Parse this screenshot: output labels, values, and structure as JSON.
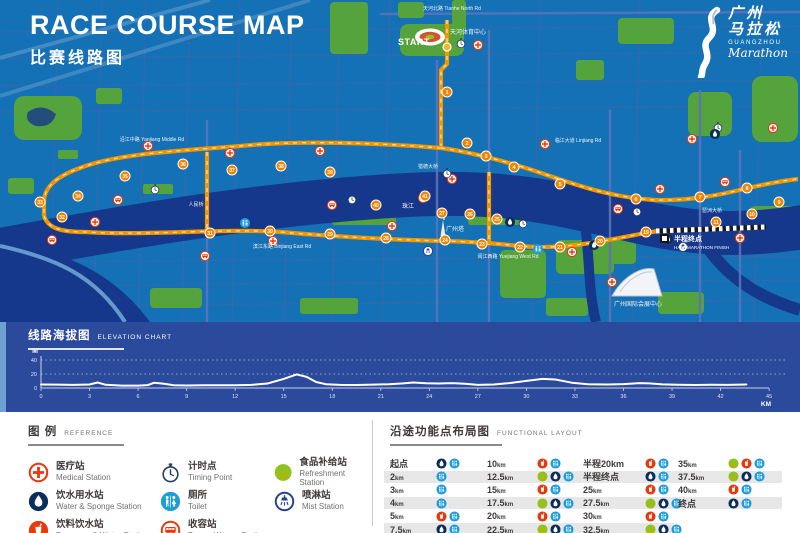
{
  "page": {
    "title_en": "RACE COURSE MAP",
    "title_zh": "比赛线路图"
  },
  "logo": {
    "zh1": "广州",
    "zh2": "马拉松",
    "en1": "GUANGZHOU",
    "en2": "Marathon"
  },
  "colors": {
    "map_bg": "#1471b5",
    "river": "#16388c",
    "shore": "#79b1dd",
    "park": "#55a33c",
    "road": "#4a63ac",
    "road_major": "#5b74bb",
    "road_light": "#6fa4d4",
    "route": "#f29600",
    "route_dash": "#ffdfa8",
    "marker": "#f08300",
    "panel": "#2b4a9b",
    "red": "#e8380d",
    "green": "#8fc31f",
    "orange": "#f39800",
    "navy": "#0b2d5b",
    "blue": "#1e9cd7",
    "ring_navy": "#24418f",
    "gray_bar": "#e7e7e8",
    "text_dark": "#3e3a39",
    "text_gray": "#727171"
  },
  "map": {
    "start_label": "START",
    "half_finish": {
      "zh": "半程终点",
      "en": "HALF MARATHON FINISH"
    },
    "labels": [
      {
        "t": "天河北路 Tianhe North Rd",
        "x": 452,
        "y": 10,
        "s": 5
      },
      {
        "t": "天河体育中心",
        "x": 468,
        "y": 34,
        "s": 6
      },
      {
        "t": "临江大道 Linjiang Rd",
        "x": 578,
        "y": 142,
        "s": 5
      },
      {
        "t": "沿江中路 Yanjiang Middle Rd",
        "x": 152,
        "y": 141,
        "s": 5
      },
      {
        "t": "滨江东路 Binjiang East Rd",
        "x": 282,
        "y": 248,
        "s": 5
      },
      {
        "t": "阅江西路 Yuejiang West Rd",
        "x": 508,
        "y": 258,
        "s": 5
      },
      {
        "t": "珠江",
        "x": 408,
        "y": 208,
        "s": 6
      },
      {
        "t": "广州塔",
        "x": 455,
        "y": 231,
        "s": 6
      },
      {
        "t": "猎德大桥",
        "x": 428,
        "y": 168,
        "s": 5
      },
      {
        "t": "人民桥",
        "x": 196,
        "y": 206,
        "s": 5
      },
      {
        "t": "琶洲大桥",
        "x": 712,
        "y": 212,
        "s": 5
      },
      {
        "t": "广州国际会展中心",
        "x": 638,
        "y": 306,
        "s": 6
      }
    ],
    "km_markers": [
      {
        "n": 1,
        "x": 447,
        "y": 92
      },
      {
        "n": 2,
        "x": 467,
        "y": 143
      },
      {
        "n": 3,
        "x": 486,
        "y": 156
      },
      {
        "n": 4,
        "x": 514,
        "y": 167
      },
      {
        "n": 5,
        "x": 560,
        "y": 184
      },
      {
        "n": 6,
        "x": 636,
        "y": 199
      },
      {
        "n": 7,
        "x": 700,
        "y": 197
      },
      {
        "n": 8,
        "x": 747,
        "y": 188
      },
      {
        "n": 9,
        "x": 779,
        "y": 202
      },
      {
        "n": 10,
        "x": 752,
        "y": 214
      },
      {
        "n": 11,
        "x": 716,
        "y": 222
      },
      {
        "n": 19,
        "x": 646,
        "y": 232
      },
      {
        "n": 20,
        "x": 600,
        "y": 241
      },
      {
        "n": 21,
        "x": 560,
        "y": 247
      },
      {
        "n": 22,
        "x": 520,
        "y": 247
      },
      {
        "n": 23,
        "x": 482,
        "y": 244
      },
      {
        "n": 24,
        "x": 445,
        "y": 240
      },
      {
        "n": 25,
        "x": 497,
        "y": 219
      },
      {
        "n": 26,
        "x": 470,
        "y": 214
      },
      {
        "n": 27,
        "x": 442,
        "y": 213
      },
      {
        "n": 28,
        "x": 386,
        "y": 238
      },
      {
        "n": 29,
        "x": 330,
        "y": 234
      },
      {
        "n": 30,
        "x": 270,
        "y": 231
      },
      {
        "n": 31,
        "x": 210,
        "y": 233
      },
      {
        "n": 32,
        "x": 62,
        "y": 217
      },
      {
        "n": 33,
        "x": 40,
        "y": 202
      },
      {
        "n": 34,
        "x": 78,
        "y": 196
      },
      {
        "n": 35,
        "x": 125,
        "y": 176
      },
      {
        "n": 36,
        "x": 183,
        "y": 164
      },
      {
        "n": 37,
        "x": 232,
        "y": 170
      },
      {
        "n": 38,
        "x": 281,
        "y": 166
      },
      {
        "n": 39,
        "x": 330,
        "y": 172
      },
      {
        "n": 40,
        "x": 376,
        "y": 205
      },
      {
        "n": 41,
        "x": 425,
        "y": 196
      }
    ],
    "stations": [
      {
        "t": "medical",
        "x": 478,
        "y": 45
      },
      {
        "t": "medical",
        "x": 148,
        "y": 146
      },
      {
        "t": "medical",
        "x": 230,
        "y": 153
      },
      {
        "t": "medical",
        "x": 320,
        "y": 151
      },
      {
        "t": "medical",
        "x": 95,
        "y": 222
      },
      {
        "t": "medical",
        "x": 273,
        "y": 241
      },
      {
        "t": "medical",
        "x": 392,
        "y": 226
      },
      {
        "t": "medical",
        "x": 452,
        "y": 179
      },
      {
        "t": "medical",
        "x": 545,
        "y": 144
      },
      {
        "t": "medical",
        "x": 612,
        "y": 282
      },
      {
        "t": "medical",
        "x": 660,
        "y": 189
      },
      {
        "t": "medical",
        "x": 692,
        "y": 139
      },
      {
        "t": "medical",
        "x": 740,
        "y": 238
      },
      {
        "t": "medical",
        "x": 773,
        "y": 128
      },
      {
        "t": "medical",
        "x": 572,
        "y": 252
      },
      {
        "t": "timing",
        "x": 461,
        "y": 43
      },
      {
        "t": "timing",
        "x": 155,
        "y": 189
      },
      {
        "t": "timing",
        "x": 352,
        "y": 199
      },
      {
        "t": "timing",
        "x": 447,
        "y": 173
      },
      {
        "t": "timing",
        "x": 523,
        "y": 223
      },
      {
        "t": "timing",
        "x": 637,
        "y": 211
      },
      {
        "t": "timing",
        "x": 718,
        "y": 127
      },
      {
        "t": "broom",
        "x": 52,
        "y": 240
      },
      {
        "t": "broom",
        "x": 205,
        "y": 256
      },
      {
        "t": "broom",
        "x": 332,
        "y": 205
      },
      {
        "t": "broom",
        "x": 423,
        "y": 198
      },
      {
        "t": "broom",
        "x": 618,
        "y": 209
      },
      {
        "t": "broom",
        "x": 725,
        "y": 182
      },
      {
        "t": "broom",
        "x": 118,
        "y": 200
      },
      {
        "t": "water",
        "x": 510,
        "y": 222
      },
      {
        "t": "water",
        "x": 594,
        "y": 245
      },
      {
        "t": "water",
        "x": 668,
        "y": 239
      },
      {
        "t": "water",
        "x": 715,
        "y": 134
      },
      {
        "t": "toilet",
        "x": 538,
        "y": 249
      },
      {
        "t": "toilet",
        "x": 245,
        "y": 223
      },
      {
        "t": "mist",
        "x": 683,
        "y": 247
      },
      {
        "t": "mist",
        "x": 428,
        "y": 251
      }
    ]
  },
  "elevation": {
    "title_zh": "线路海拔图",
    "title_en": "ELEVATION CHART",
    "y_unit": "M",
    "x_unit": "KM"
  },
  "chart_data": {
    "type": "line",
    "title": "线路海拔图 ELEVATION CHART",
    "xlabel": "KM",
    "ylabel": "M",
    "xlim": [
      0,
      45
    ],
    "ylim": [
      0,
      40
    ],
    "x_ticks": [
      0,
      3,
      6,
      9,
      12,
      15,
      18,
      21,
      24,
      27,
      30,
      33,
      36,
      39,
      42,
      45
    ],
    "y_ticks": [
      0,
      20,
      40
    ],
    "grid": "dotted horizontal",
    "legend_position": "none",
    "series": [
      {
        "name": "course elevation (m)",
        "points": [
          [
            0,
            5
          ],
          [
            1,
            4.8
          ],
          [
            2,
            4.4
          ],
          [
            3,
            5
          ],
          [
            3.5,
            7.8
          ],
          [
            4,
            4.6
          ],
          [
            5,
            3.4
          ],
          [
            6,
            3.4
          ],
          [
            6.6,
            4.2
          ],
          [
            7,
            7.6
          ],
          [
            7.6,
            6.2
          ],
          [
            8.2,
            4
          ],
          [
            9,
            3.6
          ],
          [
            10,
            3.8
          ],
          [
            11,
            4
          ],
          [
            12,
            4
          ],
          [
            13,
            4.4
          ],
          [
            14,
            6.5
          ],
          [
            15,
            13
          ],
          [
            15.8,
            19.5
          ],
          [
            16.4,
            16
          ],
          [
            17,
            8.5
          ],
          [
            17.6,
            5.4
          ],
          [
            18.5,
            4.4
          ],
          [
            19.5,
            4.3
          ],
          [
            20.5,
            4.8
          ],
          [
            21.5,
            5.4
          ],
          [
            22.4,
            6.6
          ],
          [
            23,
            7.8
          ],
          [
            23.8,
            6.8
          ],
          [
            24.6,
            6.4
          ],
          [
            25.4,
            7
          ],
          [
            26.2,
            6.2
          ],
          [
            27,
            4.4
          ],
          [
            28,
            5
          ],
          [
            29,
            7.2
          ],
          [
            30,
            10.2
          ],
          [
            31,
            13
          ],
          [
            31.8,
            12.2
          ],
          [
            32.8,
            7.6
          ],
          [
            33.8,
            5.4
          ],
          [
            35,
            5
          ],
          [
            36,
            5.6
          ],
          [
            37,
            7
          ],
          [
            37.6,
            6.6
          ],
          [
            38.4,
            5.2
          ],
          [
            39.4,
            4.6
          ],
          [
            40.4,
            4.3
          ],
          [
            41.4,
            4.6
          ],
          [
            42.4,
            4.4
          ],
          [
            43.2,
            4.8
          ],
          [
            43.6,
            5
          ]
        ]
      }
    ]
  },
  "legend": {
    "title_zh": "图 例",
    "title_en": "REFERENCE",
    "items": [
      {
        "icon": "medical",
        "zh": "医疗站",
        "en": "Medical Station"
      },
      {
        "icon": "water",
        "zh": "饮水用水站",
        "en": "Water & Sponge Station"
      },
      {
        "icon": "beverage",
        "zh": "饮料饮水站",
        "en": "Beverage & Water Station"
      },
      {
        "icon": "timing",
        "zh": "计时点",
        "en": "Timing Point"
      },
      {
        "icon": "toilet",
        "zh": "厕所",
        "en": "Toilet"
      },
      {
        "icon": "broom",
        "zh": "收容站",
        "en": "Broom Wagon Station"
      },
      {
        "icon": "refreshment",
        "zh": "食品补给站",
        "en": "Refreshment Station"
      },
      {
        "icon": "mist",
        "zh": "喷淋站",
        "en": "Mist Station"
      }
    ]
  },
  "functional": {
    "title_zh": "沿途功能点布局图",
    "title_en": "FUNCTIONAL LAYOUT",
    "columns": [
      [
        {
          "label": "起点",
          "unit": "",
          "icons": [
            "water",
            "toilet"
          ]
        },
        {
          "label": "2",
          "unit": "km",
          "icons": [
            "toilet"
          ]
        },
        {
          "label": "3",
          "unit": "km",
          "icons": [
            "toilet"
          ]
        },
        {
          "label": "4",
          "unit": "km",
          "icons": [
            "toilet"
          ]
        },
        {
          "label": "5",
          "unit": "km",
          "icons": [
            "beverage",
            "toilet"
          ]
        },
        {
          "label": "7.5",
          "unit": "km",
          "icons": [
            "water",
            "toilet"
          ]
        }
      ],
      [
        {
          "label": "10",
          "unit": "km",
          "icons": [
            "beverage",
            "toilet"
          ]
        },
        {
          "label": "12.5",
          "unit": "km",
          "icons": [
            "refreshment",
            "water",
            "toilet"
          ]
        },
        {
          "label": "15",
          "unit": "km",
          "icons": [
            "beverage",
            "toilet"
          ]
        },
        {
          "label": "17.5",
          "unit": "km",
          "icons": [
            "refreshment",
            "water",
            "toilet"
          ]
        },
        {
          "label": "20",
          "unit": "km",
          "icons": [
            "beverage",
            "toilet"
          ]
        },
        {
          "label": "22.5",
          "unit": "km",
          "icons": [
            "refreshment",
            "water",
            "toilet"
          ]
        }
      ],
      [
        {
          "label": "半程20km",
          "unit": "",
          "icons": [
            "beverage",
            "toilet"
          ]
        },
        {
          "label": "半程终点",
          "unit": "",
          "icons": [
            "water",
            "toilet"
          ]
        },
        {
          "label": "25",
          "unit": "km",
          "icons": [
            "beverage",
            "toilet"
          ]
        },
        {
          "label": "27.5",
          "unit": "km",
          "icons": [
            "refreshment",
            "water",
            "toilet"
          ]
        },
        {
          "label": "30",
          "unit": "km",
          "icons": [
            "beverage",
            "toilet"
          ]
        },
        {
          "label": "32.5",
          "unit": "km",
          "icons": [
            "refreshment",
            "water",
            "toilet"
          ]
        }
      ],
      [
        {
          "label": "35",
          "unit": "km",
          "icons": [
            "refreshment",
            "beverage",
            "toilet"
          ]
        },
        {
          "label": "37.5",
          "unit": "km",
          "icons": [
            "refreshment",
            "water",
            "toilet"
          ]
        },
        {
          "label": "40",
          "unit": "km",
          "icons": [
            "beverage",
            "toilet"
          ]
        },
        {
          "label": "终点",
          "unit": "",
          "icons": [
            "water",
            "toilet"
          ]
        }
      ]
    ]
  }
}
